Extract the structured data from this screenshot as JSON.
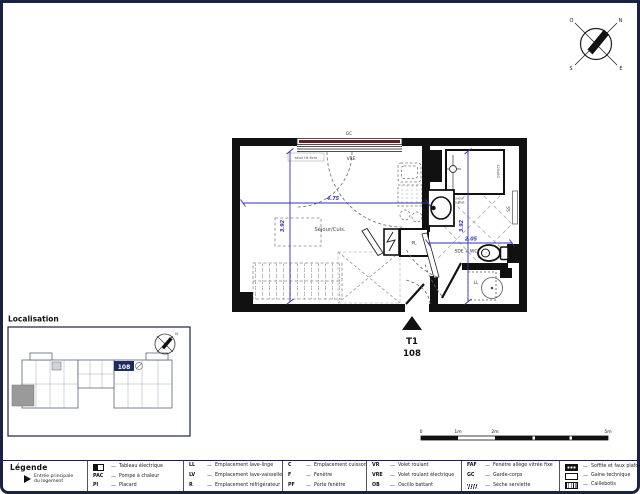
{
  "page": {
    "background": "#ffffff",
    "border_color": "#1b2342"
  },
  "compass": {
    "n": "N",
    "e": "E",
    "s": "S",
    "o": "O"
  },
  "floor_plan": {
    "unit_type": "T1",
    "unit_number": "108",
    "living_label": "Séjour/Cuis.",
    "bathroom_label": "SDE + WC",
    "window": {
      "guard_label": "GC",
      "type_label": "VRE",
      "sill_note": "seuil Ht 6cm"
    },
    "fixtures": {
      "closet": "PL",
      "towel_dryer": "SS",
      "washer": "LL",
      "shower_size": "120x80",
      "shower_note_1": "receveur",
      "shower_note_2": "extra plat"
    },
    "dimensions": {
      "living_width": "4.75",
      "living_height": "3.92",
      "bath_width": "2.05",
      "bath_height": "3.92"
    },
    "colors": {
      "dimension_blue": "#3232b4",
      "shutter_red": "#5f2120",
      "wall_black": "#111111"
    }
  },
  "localisation": {
    "title": "Localisation",
    "highlighted_unit": "108"
  },
  "scale_bar": {
    "ticks": [
      "0",
      "1m",
      "2m",
      "5m"
    ]
  },
  "legend": {
    "title": "Légende",
    "entrance": {
      "label_line1": "Entrée principale",
      "label_line2": "du logement"
    },
    "columns": [
      {
        "items": [
          {
            "icon": "electrical-panel-icon",
            "label": "Tableau électrique"
          },
          {
            "code": "PAC",
            "label": "Pompe à chaleur"
          },
          {
            "code": "Pl",
            "label": "Placard"
          }
        ]
      },
      {
        "items": [
          {
            "code": "LL",
            "label": "Emplacement lave-linge"
          },
          {
            "code": "LV",
            "label": "Emplacement lave-vaisselle"
          },
          {
            "code": "R",
            "label": "Emplacement réfrigérateur"
          }
        ]
      },
      {
        "items": [
          {
            "code": "C",
            "label": "Emplacement cuisson"
          },
          {
            "code": "F",
            "label": "Fenêtre"
          },
          {
            "code": "PF",
            "label": "Porte fenêtre"
          }
        ]
      },
      {
        "items": [
          {
            "code": "VR",
            "label": "Volet roulant"
          },
          {
            "code": "VRE",
            "label": "Volet roulant électrique"
          },
          {
            "code": "OB",
            "label": "Oscillo battant"
          }
        ]
      },
      {
        "items": [
          {
            "code": "FAF",
            "label": "Fenêtre allège vitrée fixe"
          },
          {
            "code": "GC",
            "label": "Garde-corps"
          },
          {
            "icon": "towel-dryer-icon",
            "label": "Sèche serviette"
          }
        ]
      },
      {
        "items": [
          {
            "icon": "soffit-icon",
            "label": "Soffite et faux plafond"
          },
          {
            "icon": "duct-icon",
            "label": "Gaine technique"
          },
          {
            "icon": "grating-icon",
            "label": "Caillebotis"
          }
        ]
      }
    ]
  }
}
